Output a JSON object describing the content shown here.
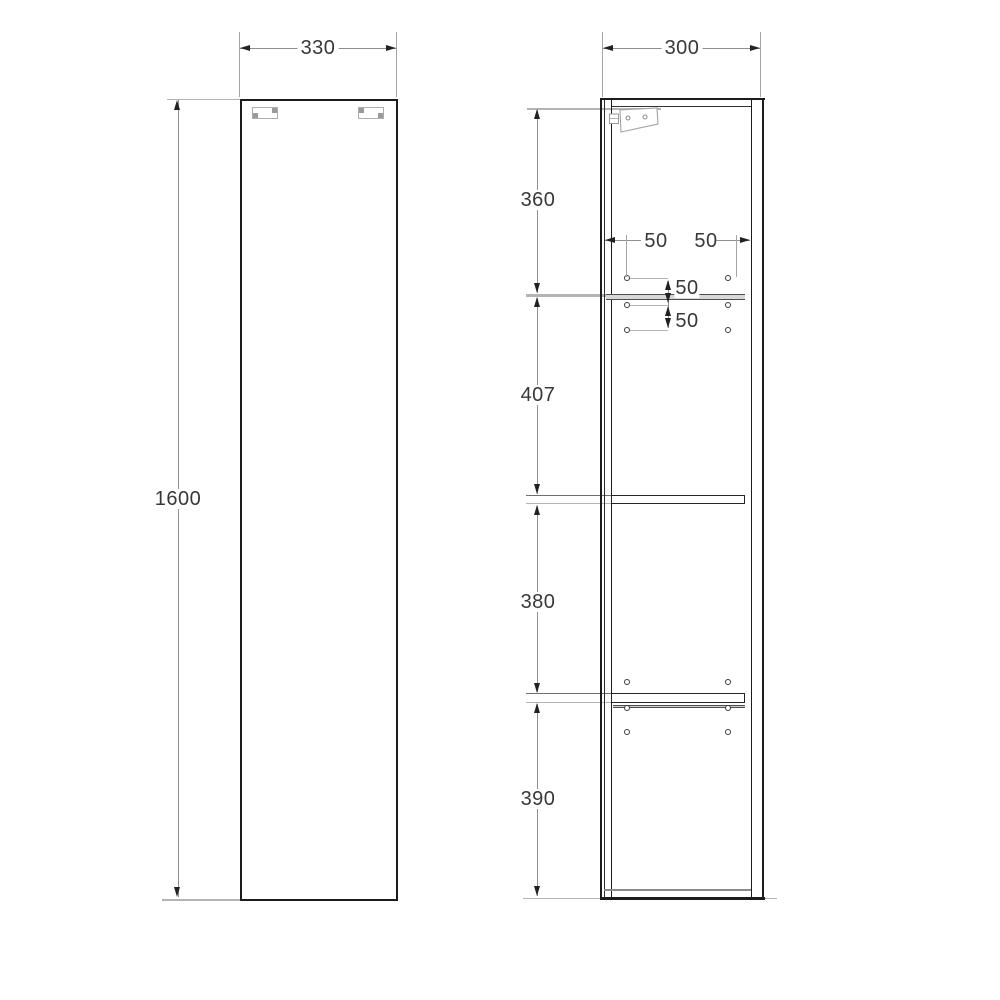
{
  "dimensions": {
    "front_width": "330",
    "depth": "300",
    "height": "1600",
    "top_section": "360",
    "upper_middle_section": "407",
    "lower_middle_section": "380",
    "bottom_section": "390",
    "hole_inset_left": "50",
    "hole_inset_right": "50",
    "hole_pitch_upper": "50",
    "hole_pitch_lower": "50"
  },
  "colors": {
    "outline": "#1c1c1c",
    "dimension_line": "#8f8f8f",
    "extension_line": "#b3b3b3",
    "label_text": "#383838",
    "bracket": "#a8a8a8",
    "shelf_edge": "#4e4e4e"
  }
}
